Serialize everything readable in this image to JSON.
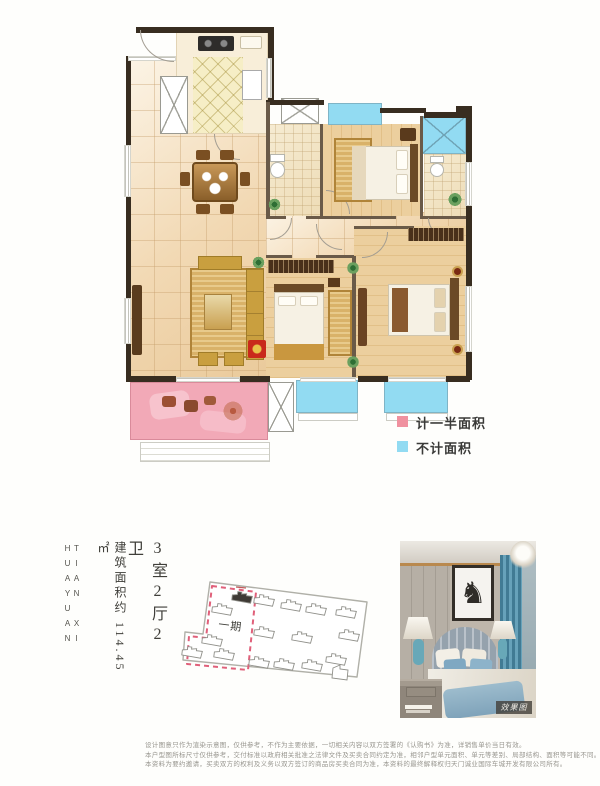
{
  "brand": {
    "vertical_name": "TIAN XI HUAYUAN"
  },
  "unit": {
    "layout_label": "3室2厅2卫",
    "area_label": "建筑面积约 114.45㎡"
  },
  "legend": {
    "half_area_label": "计一半面积",
    "half_area_color": "#f0919f",
    "excluded_area_label": "不计面积",
    "excluded_area_color": "#92dbf2"
  },
  "site_plan": {
    "phase_label": "一期"
  },
  "photo": {
    "watermark_label": "效果图"
  },
  "disclaimer": {
    "line1": "设计图意只作为渲染示意图，仅供参考，不作为主要依据，一切相关内容以双方签署的《认购书》为准，详销售单价当日有效。",
    "line2": "本户型图所标尺寸仅供参考，交付标准以政府相关批准之法律文件及买卖合同约定为准，相邻户型单元面积、单元等差别、局部结构、面积等可能不同。",
    "line3": "本资料为要约邀请，买卖双方的权利及义务以双方签订的商品房买卖合同为准，本资料的最终解释权归天门诚业国际车城开发有限公司所有。"
  }
}
